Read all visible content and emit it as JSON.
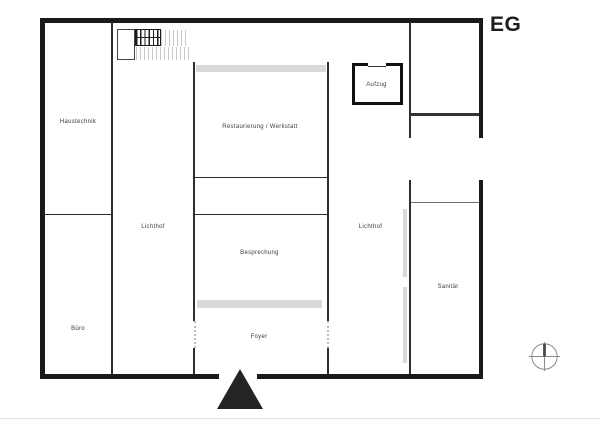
{
  "page": {
    "floor_label": "EG",
    "type": "floor-plan"
  },
  "rooms": [
    {
      "id": "haustechnik",
      "label": "Haustechnik"
    },
    {
      "id": "lichthof-left",
      "label": "Lichthof"
    },
    {
      "id": "buero",
      "label": "Büro"
    },
    {
      "id": "restaurierung",
      "label": "Restaurierung / Werkstatt"
    },
    {
      "id": "besprechung",
      "label": "Besprechung"
    },
    {
      "id": "foyer",
      "label": "Foyer"
    },
    {
      "id": "aufzug",
      "label": "Aufzug"
    },
    {
      "id": "lichthof-right",
      "label": "Lichthof"
    },
    {
      "id": "sanitaer",
      "label": "Sanitär"
    }
  ],
  "icons": [
    {
      "name": "stairs-icon",
      "meaning": "staircase with treads and landing"
    },
    {
      "name": "north-compass-icon",
      "meaning": "north orientation circle, north pointing up"
    },
    {
      "name": "entrance-marker-icon",
      "meaning": "black triangle marking main entrance"
    }
  ],
  "colors": {
    "background": "#ffffff",
    "wall": "#1a1a1a",
    "inner_wall": "#2e2e2e",
    "gray_line": "#707070",
    "accent_band": "#d9d9d9",
    "stair_tread": "#c9c9c9",
    "label_text": "#3d3d3d",
    "page_rule": "#e3e3e3"
  }
}
